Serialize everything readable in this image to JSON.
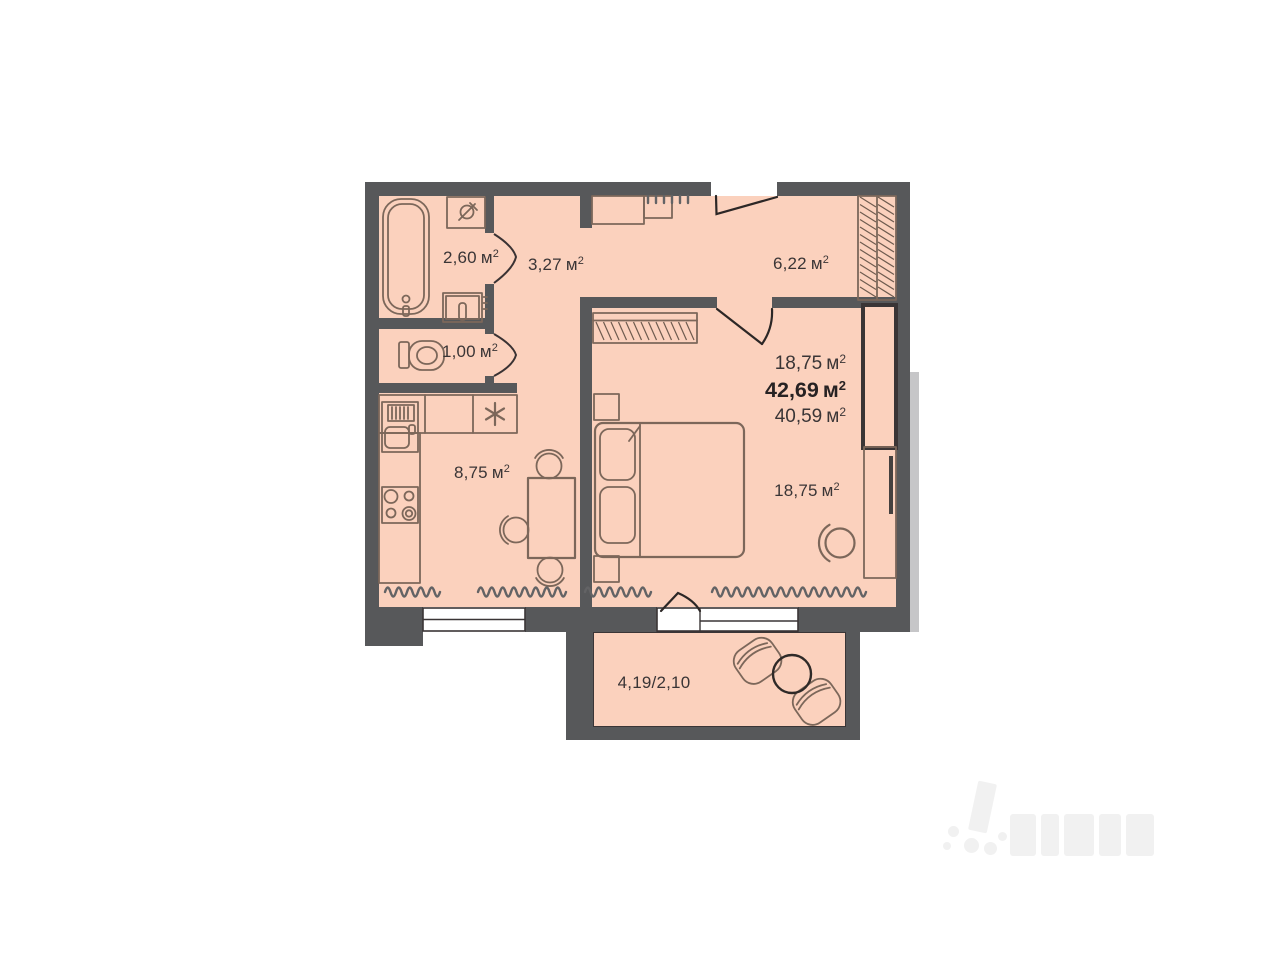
{
  "plan": {
    "unit": "м",
    "unit_sup": "2",
    "rooms": {
      "bathroom": {
        "area": "2,60"
      },
      "hall": {
        "area": "3,27"
      },
      "entrance_hall": {
        "area": "6,22"
      },
      "wc": {
        "area": "1,00"
      },
      "kitchen": {
        "area": "8,75"
      },
      "living_room": {
        "area": "18,75"
      },
      "balcony": {
        "area": "4,19/2,10"
      }
    },
    "summary": {
      "living_area": "18,75",
      "total_area": "42,69",
      "additional_area": "40,59"
    },
    "colors": {
      "wall": "#57585a",
      "floor": "#fbd1bd",
      "furniture_line": "#7c675a",
      "text": "#3a3536"
    }
  }
}
